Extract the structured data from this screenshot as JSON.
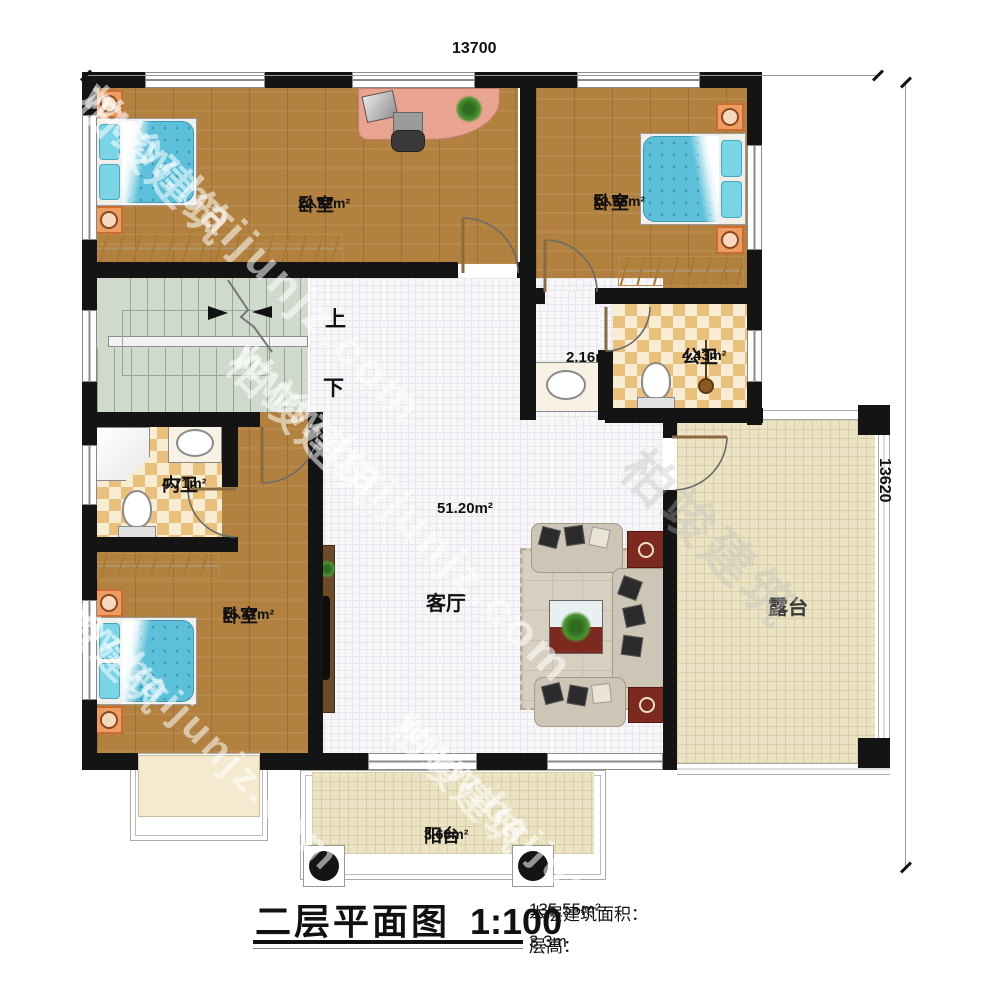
{
  "dimensions": {
    "top": "13700",
    "right": "13620"
  },
  "rooms": {
    "bedroom_tl": {
      "name": "卧室",
      "area": "22.52m²"
    },
    "bedroom_tr": {
      "name": "卧室",
      "area": "12.66m²"
    },
    "hall": {
      "area": "2.16m²"
    },
    "public_bath": {
      "name": "公卫",
      "area": "4.43m²"
    },
    "private_bath": {
      "name": "内卫",
      "area": "4.71m²"
    },
    "bedroom_bl": {
      "name": "卧室",
      "area": "15.47m²"
    },
    "living": {
      "name": "客厅",
      "area": "51.20m²"
    },
    "terrace": {
      "name": "露台"
    },
    "balcony": {
      "name": "阳台",
      "area": "3.68m²"
    }
  },
  "stairs": {
    "up": "上",
    "down": "下"
  },
  "titleblock": {
    "title": "二层平面图",
    "scale": "1:100",
    "area_label": "本层建筑面积：",
    "area_value": "135.55m²",
    "height_label": "层高：",
    "height_value": "3.3m"
  },
  "watermark": {
    "brand": "柏竣建筑",
    "url": "www.baijunjz.com"
  },
  "colors": {
    "wall": "#141414",
    "wood": "#b2813f",
    "tile_check": "#eac17c",
    "terrace": "#ebe3c3",
    "bed": "#5cc0da"
  }
}
